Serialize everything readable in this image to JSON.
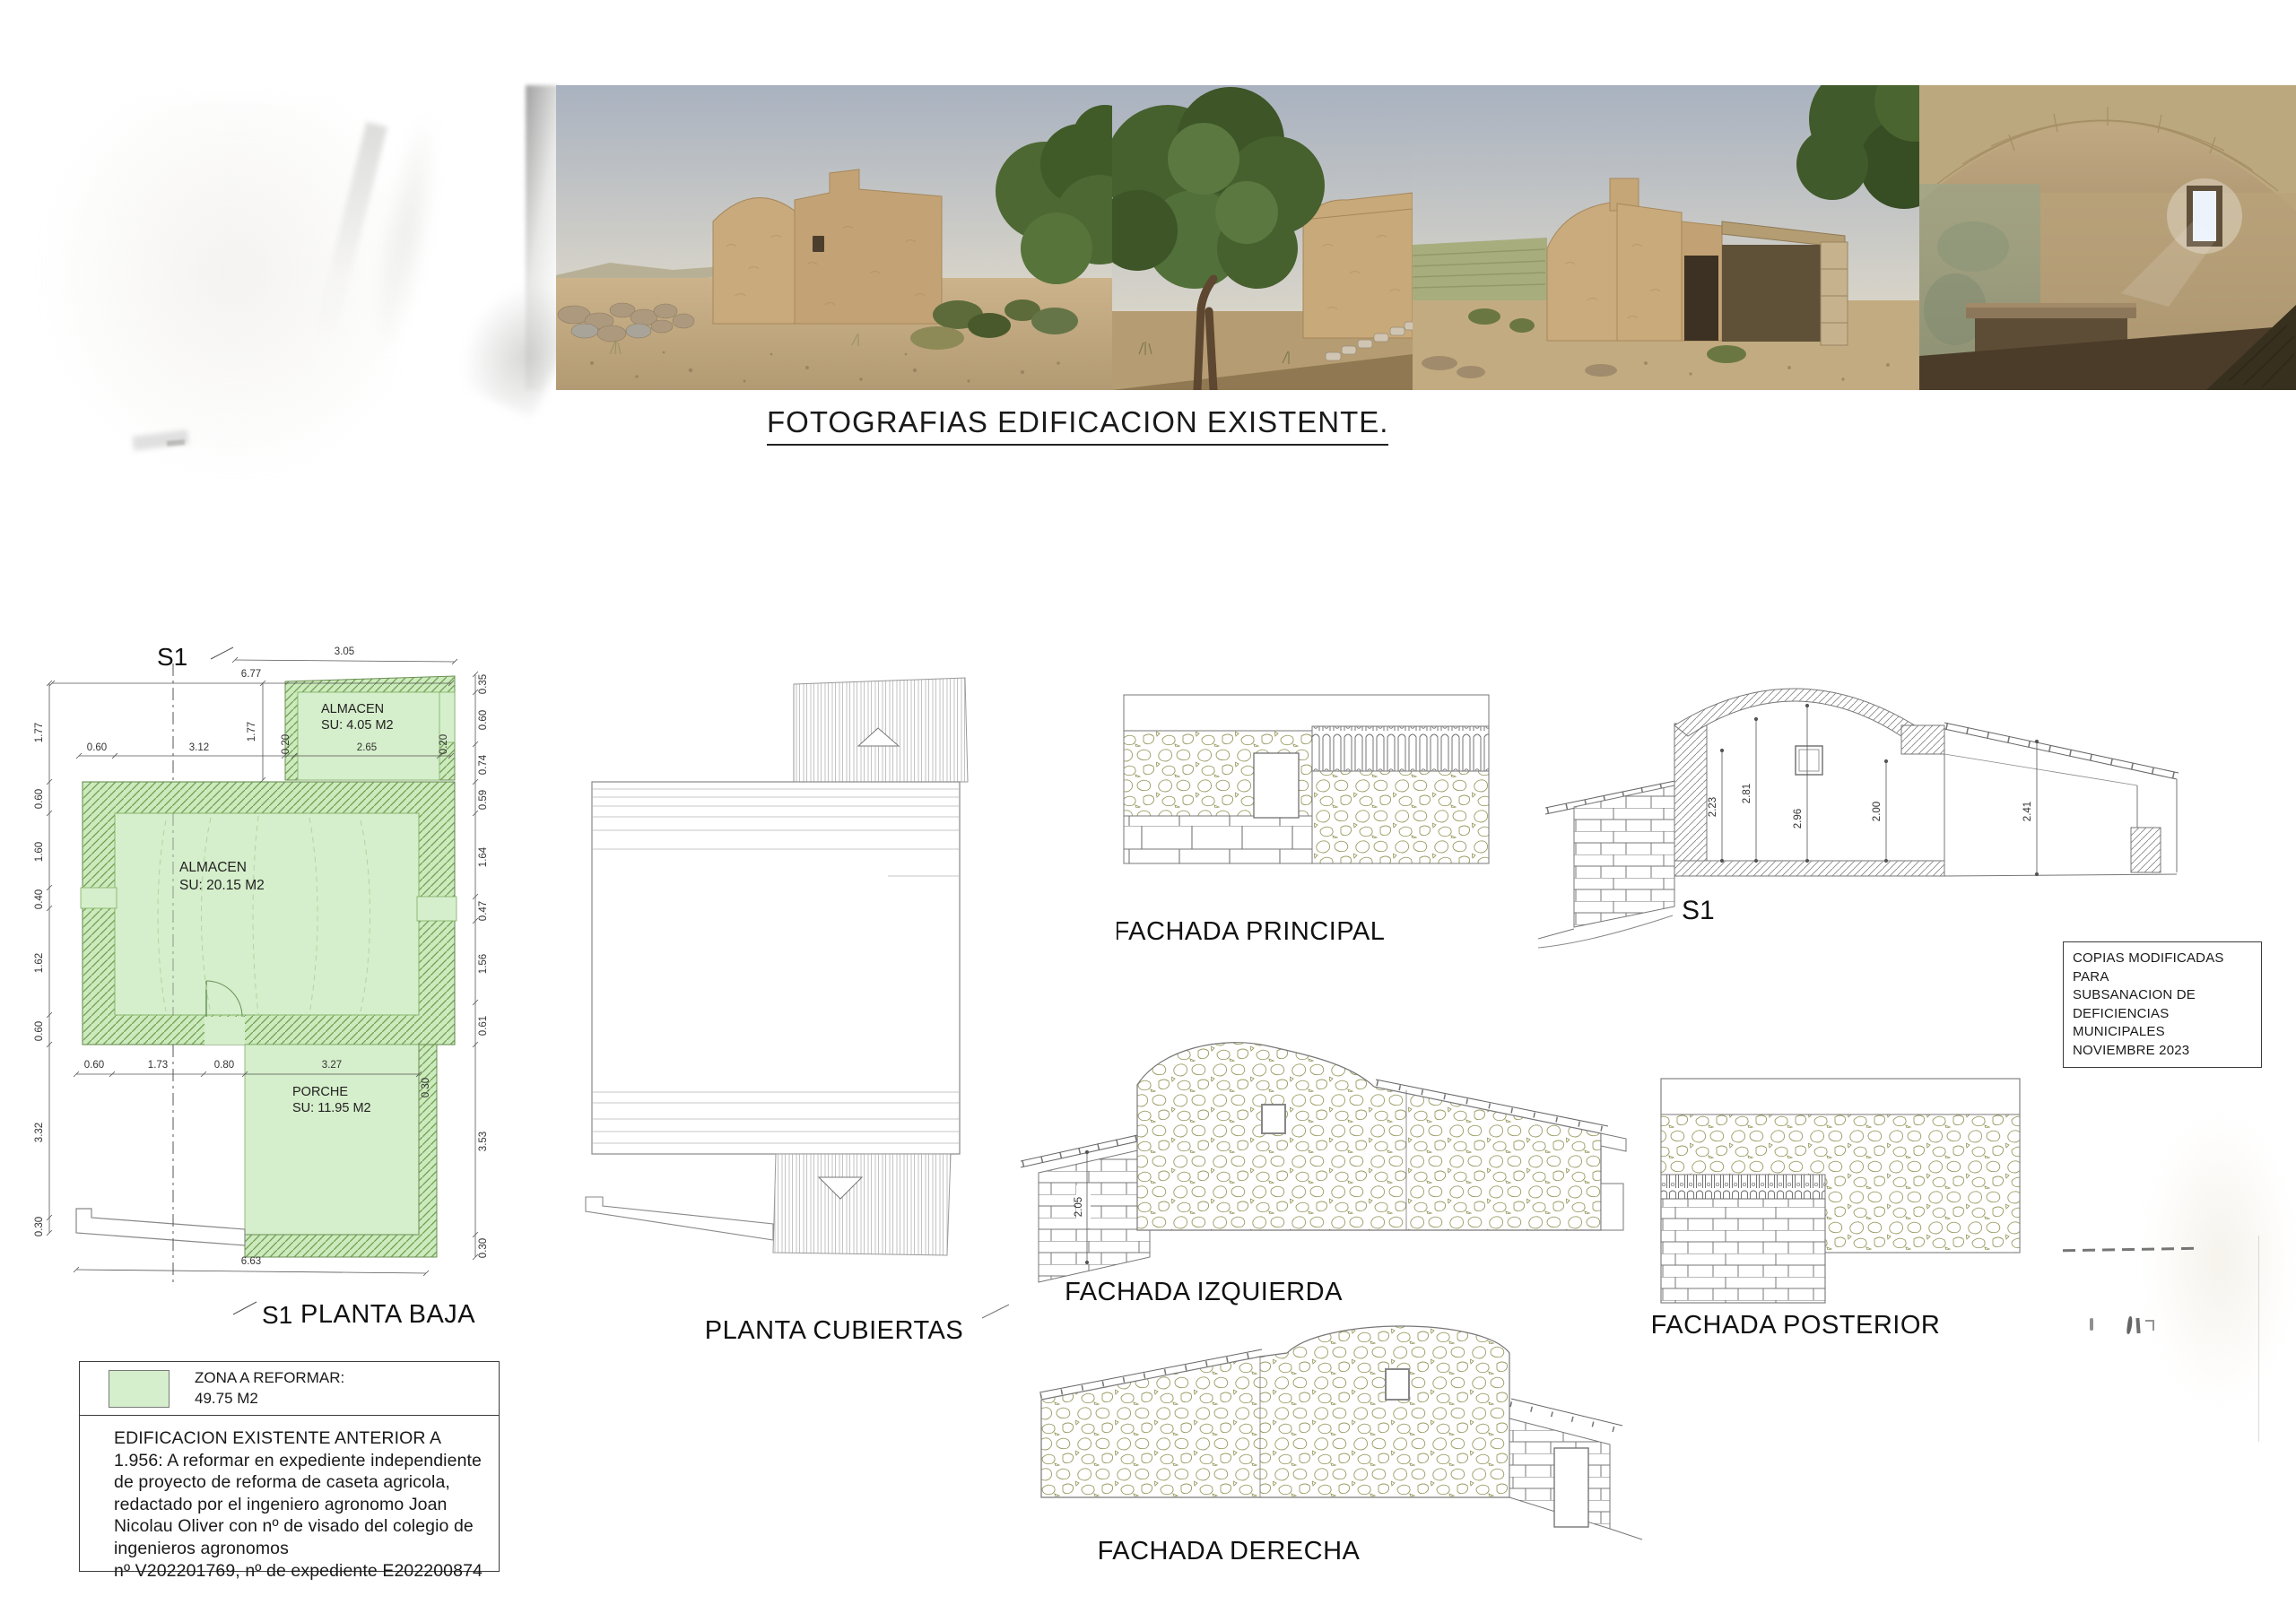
{
  "photos_section": {
    "title": "FOTOGRAFIAS EDIFICACION EXISTENTE.",
    "photo_names": [
      "exterior-front-view",
      "exterior-tree-view",
      "exterior-porch-view",
      "interior-vault-view"
    ]
  },
  "plan_baja": {
    "title": "PLANTA BAJA",
    "section_label": "S1",
    "rooms": [
      {
        "name": "ALMACEN",
        "area": "SU: 4.05 M2"
      },
      {
        "name": "ALMACEN",
        "area": "SU: 20.15 M2"
      },
      {
        "name": "PORCHE",
        "area": "SU: 11.95 M2"
      }
    ],
    "dims": {
      "top_slanted": "3.05",
      "top_total": "6.77",
      "top_vertical": "1.77",
      "inner_top": [
        "0.60",
        "3.12",
        "0.20",
        "2.65",
        "0.20"
      ],
      "left": [
        "1.77",
        "0.60",
        "1.60",
        "0.40",
        "1.62",
        "0.60",
        "3.32",
        "0.30"
      ],
      "right": [
        "0.35",
        "0.60",
        "0.74",
        "0.59",
        "1.64",
        "0.47",
        "1.56",
        "0.61",
        "3.53",
        "0.30"
      ],
      "bottom": [
        "0.60",
        "1.73",
        "0.80",
        "3.27",
        "0.30"
      ],
      "bottom_total": "6.63"
    }
  },
  "plan_cubiertas": {
    "title": "PLANTA CUBIERTAS"
  },
  "fachadas": {
    "principal": "FACHADA PRINCIPAL",
    "izquierda": "FACHADA IZQUIERDA",
    "posterior": "FACHADA POSTERIOR",
    "derecha": "FACHADA DERECHA",
    "izquierda_dim": "2.05"
  },
  "seccion": {
    "label": "S1",
    "dims": [
      "2.23",
      "2.81",
      "2.96",
      "2.00",
      "2.41"
    ]
  },
  "copias_box": {
    "lines": [
      "COPIAS MODIFICADAS PARA",
      "SUBSANACION DE",
      "DEFICIENCIAS MUNICIPALES",
      "NOVIEMBRE 2023"
    ]
  },
  "legend": {
    "title": "ZONA A REFORMAR:",
    "value": "49.75 M2"
  },
  "notes": {
    "lines": [
      "EDIFICACION EXISTENTE ANTERIOR A",
      "1.956: A  reformar en expediente independiente",
      "de proyecto de reforma de caseta agricola,",
      "redactado por el ingeniero agronomo Joan",
      "Nicolau Oliver con nº de visado del colegio de",
      "ingenieros agronomos",
      "nº V202201769, nº de expediente E202200874"
    ]
  },
  "colors": {
    "reform_green": "#d5eecb",
    "hatch_green": "#6fa050",
    "stone_outline": "#9b9b63"
  }
}
